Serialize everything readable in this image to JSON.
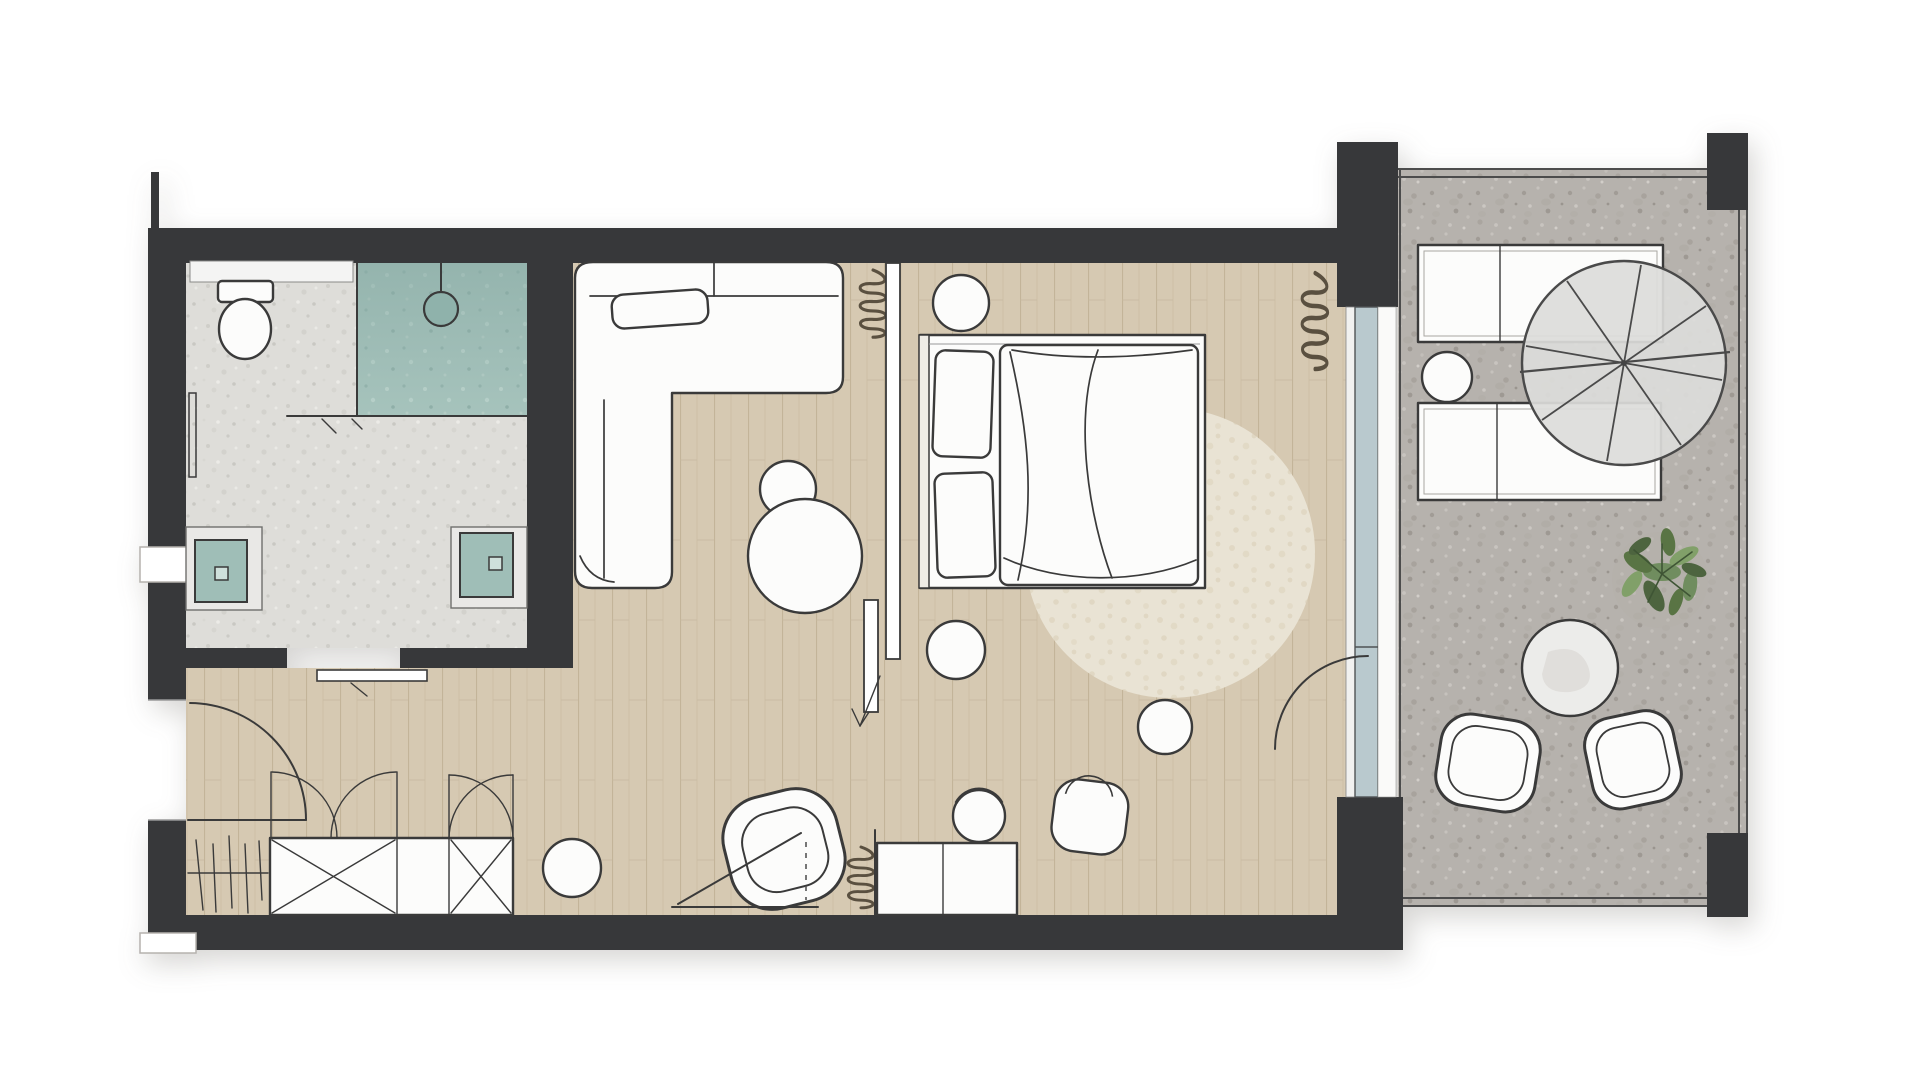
{
  "scene": {
    "kind": "architectural-floor-plan",
    "style": "hand-sketched top view of a hotel suite with terrace",
    "visible_text": []
  },
  "colors": {
    "wall": "#37383a",
    "ink": "#3a3a3a",
    "wood_floor": "#d6c9b2",
    "concrete_terrace": "#b6b2ad",
    "bathroom_terrazzo": "#deddd9",
    "shower_tile_teal": "#a6c3bc",
    "rug_beige": "#e9e3d4",
    "glass_wall_blue": "#b9c9ce",
    "paper": "#ffffff",
    "furniture_white": "#fcfcfb",
    "plant_green": "#6d8c5b",
    "squiggle_brown": "#5a5040"
  },
  "rooms": {
    "bathroom": {
      "items": [
        "toilet",
        "shower",
        "shower-head",
        "shower-screen",
        "towel-rail",
        "shelf",
        "vanity-sink-left",
        "vanity-sink-right",
        "sliding-door"
      ]
    },
    "living_area": {
      "items": [
        "l-shaped-sofa",
        "throw-pillow",
        "coffee-table",
        "pouf",
        "curtain-squiggle"
      ]
    },
    "sleeping_area": {
      "items": [
        "double-bed",
        "headboard",
        "pillows",
        "duvet",
        "nightstand-top",
        "nightstand-bottom",
        "round-rug",
        "curtain-squiggle",
        "partition-sliding-door",
        "direction-arrow",
        "terrace-door-swing"
      ]
    },
    "entry_hall": {
      "items": [
        "entry-door-swing",
        "coat-rack",
        "wardrobe-crossed",
        "wardrobe-door-swings",
        "pouf",
        "papasan-chair",
        "floor-lamp",
        "console-desk",
        "desk-chair",
        "armchair",
        "side-table"
      ]
    },
    "terrace": {
      "items": [
        "sun-lounger-top",
        "sun-lounger-bottom",
        "lounger-side-table",
        "spiral-staircase",
        "potted-plant",
        "round-table",
        "bucket-chair-left",
        "bucket-chair-right",
        "parapet",
        "pillars"
      ]
    }
  }
}
